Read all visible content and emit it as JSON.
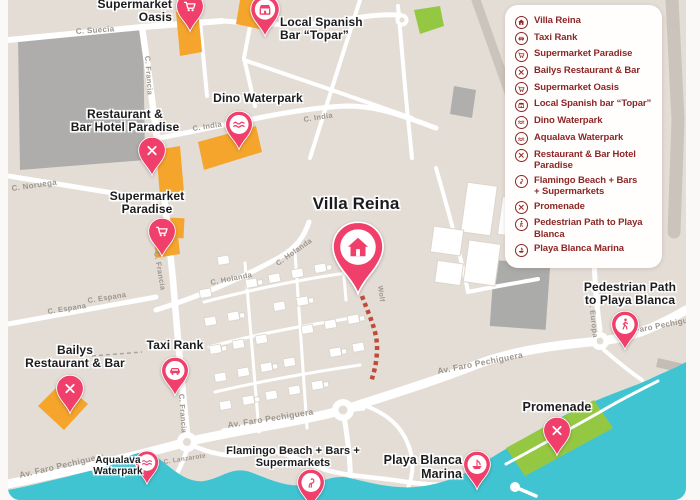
{
  "colors": {
    "page_bg": "#FAF9F8",
    "map_base": "#E4DDD6",
    "street": "#FFFFFF",
    "gray_road": "#CBC4BC",
    "building_gray": "#ACABA9",
    "building_orange": "#F5A52B",
    "green": "#94C843",
    "water": "#41C4D2",
    "pin": "#F13F6B",
    "pin_inner": "#FFFFFF",
    "label_text": "#1B1C1E",
    "street_text": "#9D968E",
    "legend_text": "#8C2726",
    "path_red": "#C04B39"
  },
  "legend": {
    "items": [
      {
        "icon": "home",
        "lines": [
          "Villa Reina"
        ]
      },
      {
        "icon": "car",
        "lines": [
          "Taxi Rank"
        ]
      },
      {
        "icon": "cart",
        "lines": [
          "Supermarket Paradise"
        ]
      },
      {
        "icon": "utensils",
        "lines": [
          "Bailys Restaurant & Bar"
        ]
      },
      {
        "icon": "cart",
        "lines": [
          "Supermarket Oasis"
        ]
      },
      {
        "icon": "shop",
        "lines": [
          "Local Spanish bar “Topar”"
        ]
      },
      {
        "icon": "wave",
        "lines": [
          "Dino Waterpark"
        ]
      },
      {
        "icon": "wave",
        "lines": [
          "Aqualava Waterpark"
        ]
      },
      {
        "icon": "utensils",
        "lines": [
          "Restaurant & Bar Hotel",
          "Paradise"
        ]
      },
      {
        "icon": "flamingo",
        "lines": [
          "Flamingo Beach + Bars",
          "+ Supermarkets"
        ]
      },
      {
        "icon": "utensils",
        "lines": [
          "Promenade"
        ]
      },
      {
        "icon": "walk",
        "lines": [
          "Pedestrian Path to Playa",
          "Blanca"
        ]
      },
      {
        "icon": "ship",
        "lines": [
          "Playa Blanca Marina"
        ]
      }
    ]
  },
  "map": {
    "markers": [
      {
        "id": "supermarket-oasis",
        "icon": "cart",
        "style": "solid",
        "size": 30,
        "pin": {
          "x": 182,
          "y": -8
        },
        "label": {
          "lines": [
            "Supermarket",
            "Oasis"
          ],
          "x": 164,
          "y": -2,
          "align": "right",
          "size": 12
        }
      },
      {
        "id": "local-spanish-bar-topar",
        "icon": "shop",
        "style": "disc",
        "size": 32,
        "pin": {
          "x": 257,
          "y": -6
        },
        "label": {
          "lines": [
            "Local Spanish",
            "Bar “Topar”"
          ],
          "x": 272,
          "y": 16,
          "align": "left",
          "size": 12
        }
      },
      {
        "id": "dino-waterpark",
        "icon": "wave",
        "style": "disc",
        "size": 30,
        "pin": {
          "x": 231,
          "y": 110
        },
        "label": {
          "lines": [
            "Dino Waterpark"
          ],
          "x": 250,
          "y": 92,
          "align": "center",
          "size": 12
        }
      },
      {
        "id": "restaurant-bar-hotel-paradise",
        "icon": "utensils",
        "style": "solid",
        "size": 30,
        "pin": {
          "x": 144,
          "y": 136
        },
        "label": {
          "lines": [
            "Restaurant &",
            "Bar Hotel Paradise"
          ],
          "x": 117,
          "y": 108,
          "align": "center",
          "size": 12
        }
      },
      {
        "id": "supermarket-paradise",
        "icon": "cart",
        "style": "solid",
        "size": 30,
        "pin": {
          "x": 154,
          "y": 217
        },
        "label": {
          "lines": [
            "Supermarket",
            "Paradise"
          ],
          "x": 139,
          "y": 190,
          "align": "center",
          "size": 12
        }
      },
      {
        "id": "villa-reina",
        "icon": "home",
        "style": "disc",
        "size": 56,
        "pin": {
          "x": 350,
          "y": 220
        },
        "label": {
          "lines": [
            "Villa Reina"
          ],
          "x": 348,
          "y": 194,
          "align": "center",
          "size": 17
        }
      },
      {
        "id": "bailys-restaurant-bar",
        "icon": "utensils",
        "style": "solid",
        "size": 30,
        "pin": {
          "x": 62,
          "y": 374
        },
        "label": {
          "lines": [
            "Bailys",
            "Restaurant & Bar"
          ],
          "x": 67,
          "y": 344,
          "align": "center",
          "size": 12
        }
      },
      {
        "id": "taxi-rank",
        "icon": "car",
        "style": "disc",
        "size": 30,
        "pin": {
          "x": 167,
          "y": 356
        },
        "label": {
          "lines": [
            "Taxi Rank"
          ],
          "x": 167,
          "y": 339,
          "align": "center",
          "size": 12
        }
      },
      {
        "id": "aqualava-waterpark",
        "icon": "wave",
        "style": "disc",
        "size": 26,
        "pin": {
          "x": 139,
          "y": 450
        },
        "label": {
          "lines": [
            "Aqualava",
            "Waterpark"
          ],
          "x": 110,
          "y": 455,
          "align": "center",
          "size": 10
        }
      },
      {
        "id": "flamingo-beach",
        "icon": "flamingo",
        "style": "disc",
        "size": 30,
        "pin": {
          "x": 303,
          "y": 468
        },
        "label": {
          "lines": [
            "Flamingo Beach + Bars +",
            "Supermarkets"
          ],
          "x": 285,
          "y": 445,
          "align": "center",
          "size": 11
        }
      },
      {
        "id": "playa-blanca-marina",
        "icon": "ship",
        "style": "disc",
        "size": 30,
        "pin": {
          "x": 469,
          "y": 450
        },
        "label": {
          "lines": [
            "Playa Blanca",
            "Marina"
          ],
          "x": 454,
          "y": 453,
          "align": "right",
          "size": 12.5
        }
      },
      {
        "id": "pedestrian-path",
        "icon": "walk",
        "style": "disc",
        "size": 30,
        "pin": {
          "x": 617,
          "y": 310
        },
        "label": {
          "lines": [
            "Pedestrian Path",
            "to Playa Blanca"
          ],
          "x": 622,
          "y": 281,
          "align": "center",
          "size": 12
        }
      },
      {
        "id": "promenade",
        "icon": "utensils",
        "style": "solid",
        "size": 30,
        "pin": {
          "x": 549,
          "y": 416
        },
        "label": {
          "lines": [
            "Promenade"
          ],
          "x": 549,
          "y": 400,
          "align": "center",
          "size": 12.5
        }
      }
    ],
    "street_labels": [
      {
        "text": "C. Suecia",
        "x": 68,
        "y": 34,
        "rot": -4,
        "size": 8
      },
      {
        "text": "C. Francia",
        "x": 137,
        "y": 56,
        "rot": 86,
        "size": 7.5
      },
      {
        "text": "C. India",
        "x": 185,
        "y": 131,
        "rot": -9,
        "size": 7.5
      },
      {
        "text": "C. India",
        "x": 296,
        "y": 122,
        "rot": -9,
        "size": 7.5
      },
      {
        "text": "C. Noruega",
        "x": 4,
        "y": 191,
        "rot": -8,
        "size": 8
      },
      {
        "text": "C. Francia",
        "x": 146,
        "y": 252,
        "rot": 80,
        "size": 7.5
      },
      {
        "text": "C. Holanda",
        "x": 203,
        "y": 285,
        "rot": -11,
        "size": 7.5
      },
      {
        "text": "C. Holanda",
        "x": 270,
        "y": 266,
        "rot": -35,
        "size": 7.5
      },
      {
        "text": "C. Espana",
        "x": 40,
        "y": 314,
        "rot": -9,
        "size": 7.5
      },
      {
        "text": "C. Espana",
        "x": 80,
        "y": 303,
        "rot": -9,
        "size": 7.5
      },
      {
        "text": "Wolf",
        "x": 370,
        "y": 286,
        "rot": 82,
        "size": 7
      },
      {
        "text": "C. Europa",
        "x": 581,
        "y": 300,
        "rot": 84,
        "size": 7.5
      },
      {
        "text": "C. Francia",
        "x": 171,
        "y": 394,
        "rot": 86,
        "size": 7.5
      },
      {
        "text": "Av. Faro Pechiguera",
        "x": 12,
        "y": 478,
        "rot": -13,
        "size": 8.5
      },
      {
        "text": "Av. Faro Pechiguera",
        "x": 220,
        "y": 428,
        "rot": -9,
        "size": 8.5
      },
      {
        "text": "Av. Faro Pechiguera",
        "x": 430,
        "y": 374,
        "rot": -11,
        "size": 8.5
      },
      {
        "text": "Faro Pechiguera",
        "x": 627,
        "y": 333,
        "rot": -11,
        "size": 8
      },
      {
        "text": "C. Lanzarote",
        "x": 156,
        "y": 464,
        "rot": -9,
        "size": 6.5
      }
    ]
  }
}
